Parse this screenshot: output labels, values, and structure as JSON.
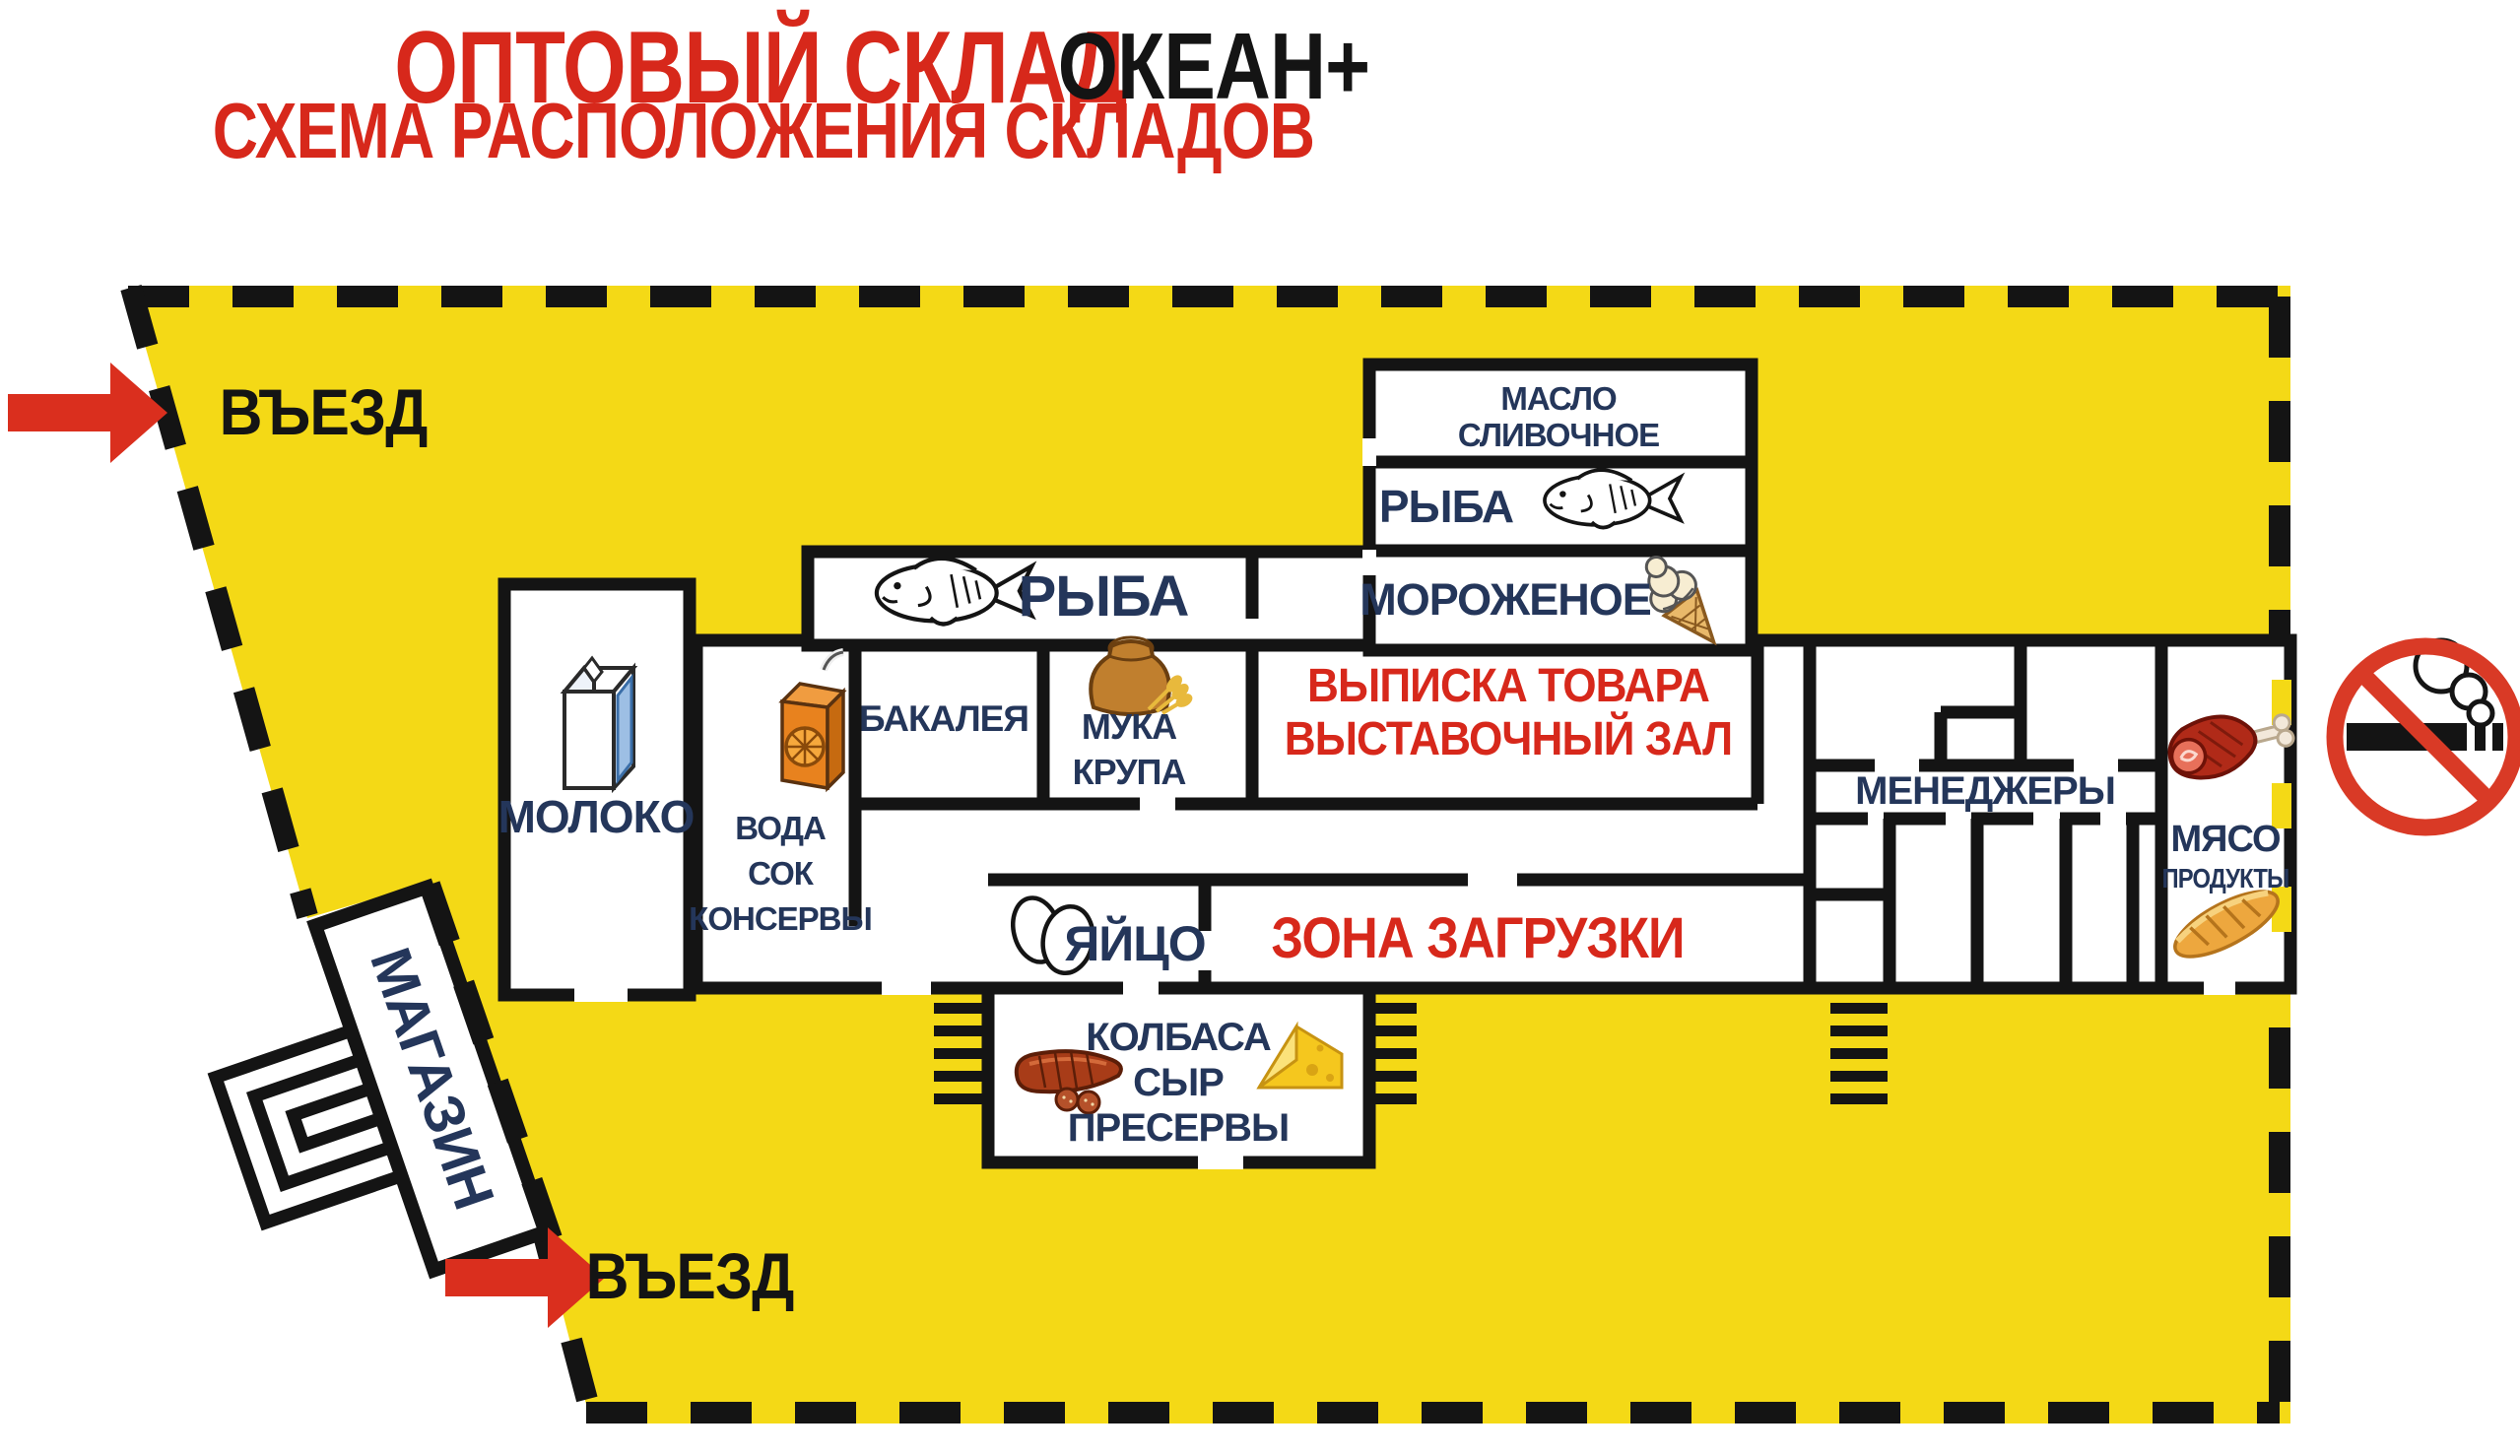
{
  "title": {
    "main": "ОПТОВЫЙ СКЛАД",
    "brand": "ОКЕАН+",
    "subtitle": "СХЕМА РАСПОЛОЖЕНИЯ СКЛАДОВ"
  },
  "map": {
    "entrance_top": "ВЪЕЗД",
    "entrance_bottom": "ВЪЕЗД",
    "shop": "МАГАЗИН",
    "rooms": {
      "moloko": "МОЛОКО",
      "voda_lines": [
        "ВОДА",
        "СОК",
        "КОНСЕРВЫ"
      ],
      "bakaleya": "БАКАЛЕЯ",
      "muka_lines": [
        "МУКА",
        "КРУПА"
      ],
      "ryba_main": "РЫБА",
      "maslo_lines": [
        "МАСЛО",
        "СЛИВОЧНОЕ"
      ],
      "ryba_small": "РЫБА",
      "morozhenoe": "МОРОЖЕНОЕ",
      "vypiska_lines": [
        "ВЫПИСКА ТОВАРА",
        "ВЫСТАВОЧНЫЙ ЗАЛ"
      ],
      "menedzhery": "МЕНЕДЖЕРЫ",
      "myaso_lines": [
        "МЯСО",
        "ПРОДУКТЫ"
      ],
      "yaytso": "ЯЙЦО",
      "zona": "ЗОНА ЗАГРУЗКИ",
      "kolbasa_lines": [
        "КОЛБАСА",
        "СЫР",
        "ПРЕСЕРВЫ"
      ]
    },
    "icons": [
      "fish-icon",
      "milk-carton-icon",
      "juice-box-icon",
      "flour-sack-icon",
      "ice-cream-icon",
      "eggs-icon",
      "sausage-icon",
      "cheese-icon",
      "ham-icon",
      "bread-icon",
      "no-smoking-icon",
      "entry-arrow-icon",
      "shop-entrance-icon"
    ]
  },
  "colors": {
    "territory_yellow": "#f4d916",
    "title_red": "#d7281b",
    "label_navy": "#24365a",
    "wall_black": "#141414",
    "arrow_red": "#da2f1e"
  }
}
